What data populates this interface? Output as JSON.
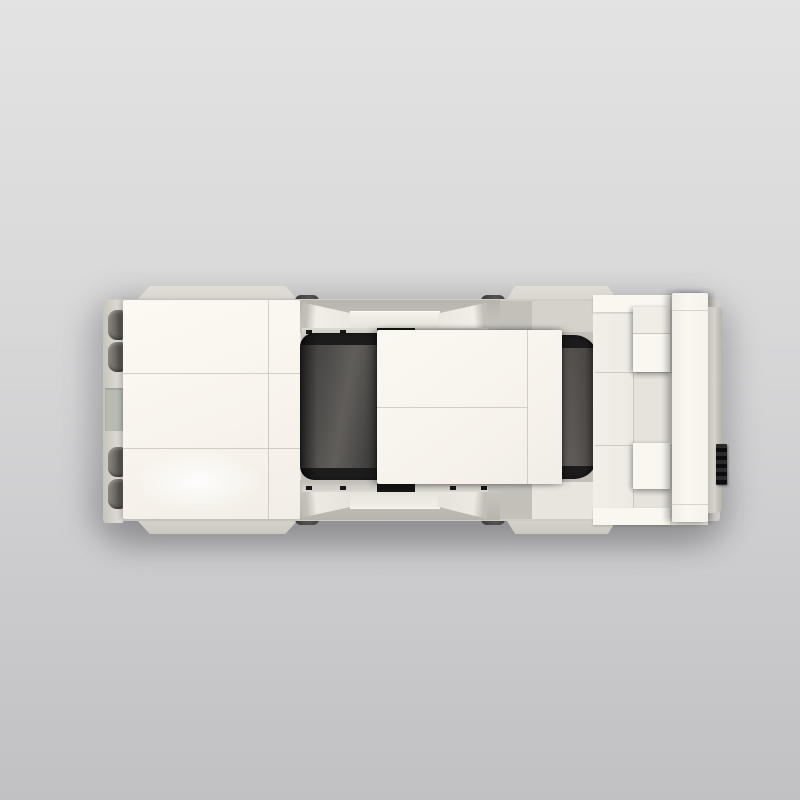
{
  "scene": {
    "title": "White brick-built car, top-down studio render",
    "subject": "lego-style brick sports car",
    "view": "top-down",
    "background": "gray studio gradient"
  },
  "colors": {
    "bg-top": "#e3e3e3",
    "bg-mid": "#d8d8d9",
    "bg-bottom": "#c1c1c3",
    "panel-white": "#faf7f1",
    "panel-white-dim": "#f2eee6",
    "tile-light": "#e6e3dc",
    "fender-gray": "#d8d5ce",
    "base-gray": "#cfccc6",
    "recess-gray": "#c3c0ba",
    "seam": "#b3afa6",
    "glass-mid": "#514f4d",
    "glass-light": "#6e6a66",
    "black-accent": "#161616",
    "tire-dark": "#55524e",
    "plate-gray": "#b7bbb2",
    "lamp-dark": "#57544f"
  },
  "parts": {
    "car": "White brick-built car seen from above",
    "hood": "Front hood tile panels",
    "front_bumper": "Front bumper strip",
    "license_plate": "Bumper plate holder",
    "lamp": "Dark light-cluster piece",
    "fender": "Gray wheel fender",
    "tire": "Tire peeking through gap",
    "side_skirt": "Side skirt with wedge slopes",
    "rail": "Door rail with black clips",
    "windshield": "Dark tinted windshield",
    "roof": "White roof panel",
    "rear_window": "Dark tinted rear window",
    "rear_deck": "Rear deck tiles",
    "deck_brick": "Raised white brick",
    "wing": "Rear wing bar",
    "rear_bumper": "Rear bumper strip",
    "exhaust": "Black ribbed grille piece",
    "shadow": "Soft drop shadow"
  }
}
